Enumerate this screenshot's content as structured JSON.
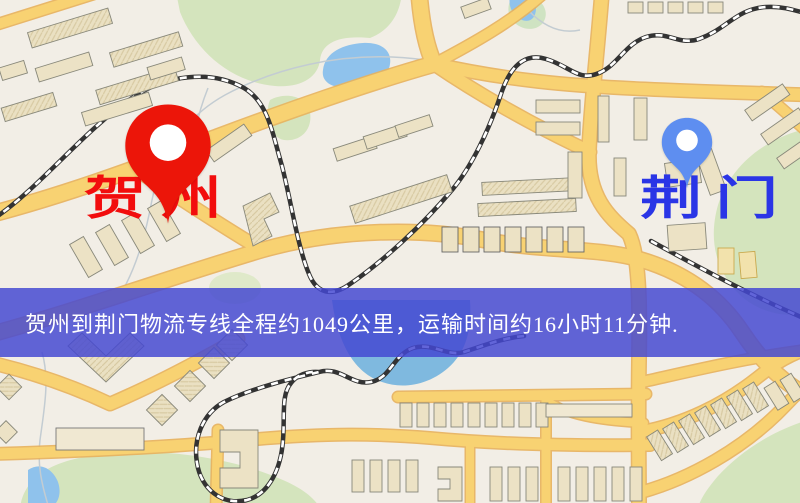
{
  "banner": {
    "text": "贺州到荆门物流专线全程约1049公里，运输时间约16小时11分钟.",
    "background": "rgba(68,72,210,0.84)",
    "text_color": "#ffffff",
    "distance_km": "1049",
    "duration_hours": "16",
    "duration_minutes": "11"
  },
  "origin": {
    "label": "贺州",
    "pin_color": "#ec1509",
    "label_color": "#f20d0d"
  },
  "destination": {
    "label": "荆门",
    "pin_color": "#5e8ef0",
    "label_color": "#2a35e6"
  },
  "map_palette": {
    "background": "#f2eee6",
    "road_fill": "#f8d272",
    "road_casing": "#e8b25c",
    "park_green": "#d4e4bd",
    "water_blue": "#8fc2ec",
    "building_fill": "#ece2c5",
    "railway_dark": "#333333"
  }
}
